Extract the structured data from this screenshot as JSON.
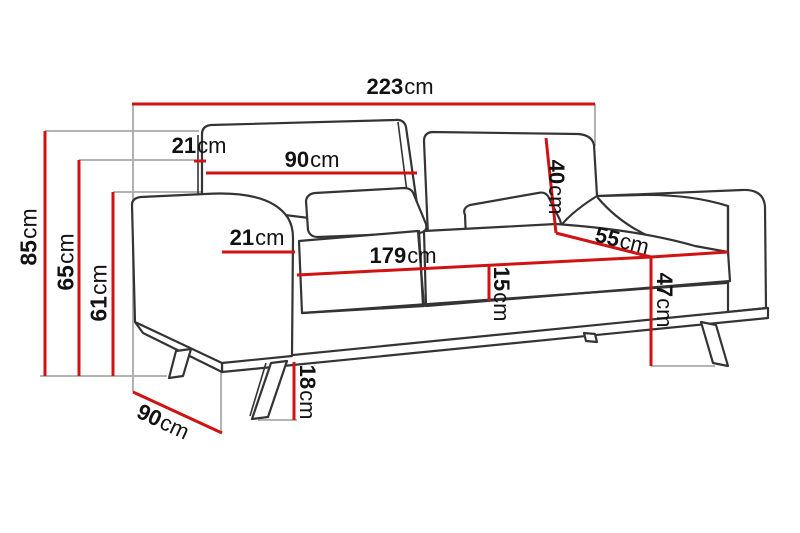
{
  "diagram": {
    "subject": "three-seat-sofa-dimension-drawing",
    "unit": "cm",
    "colors": {
      "dimension": "#d11212",
      "outline": "#343434",
      "guide": "#a9a9a9",
      "text": "#121212",
      "background": "#ffffff"
    },
    "measurements": [
      {
        "id": "total-width",
        "value": "223",
        "unit": "cm"
      },
      {
        "id": "backrest-top-depth",
        "value": "21",
        "unit": "cm"
      },
      {
        "id": "back-cushion-width",
        "value": "90",
        "unit": "cm"
      },
      {
        "id": "overall-height",
        "value": "85",
        "unit": "cm"
      },
      {
        "id": "armrest-height",
        "value": "65",
        "unit": "cm"
      },
      {
        "id": "seat-back-height",
        "value": "61",
        "unit": "cm"
      },
      {
        "id": "armrest-width",
        "value": "21",
        "unit": "cm"
      },
      {
        "id": "seat-width",
        "value": "179",
        "unit": "cm"
      },
      {
        "id": "back-cushion-height",
        "value": "40",
        "unit": "cm"
      },
      {
        "id": "seat-depth",
        "value": "55",
        "unit": "cm"
      },
      {
        "id": "seat-cushion-thickness",
        "value": "15",
        "unit": "cm"
      },
      {
        "id": "seat-height",
        "value": "47",
        "unit": "cm"
      },
      {
        "id": "leg-height",
        "value": "18",
        "unit": "cm"
      },
      {
        "id": "total-depth",
        "value": "90",
        "unit": "cm"
      }
    ]
  }
}
